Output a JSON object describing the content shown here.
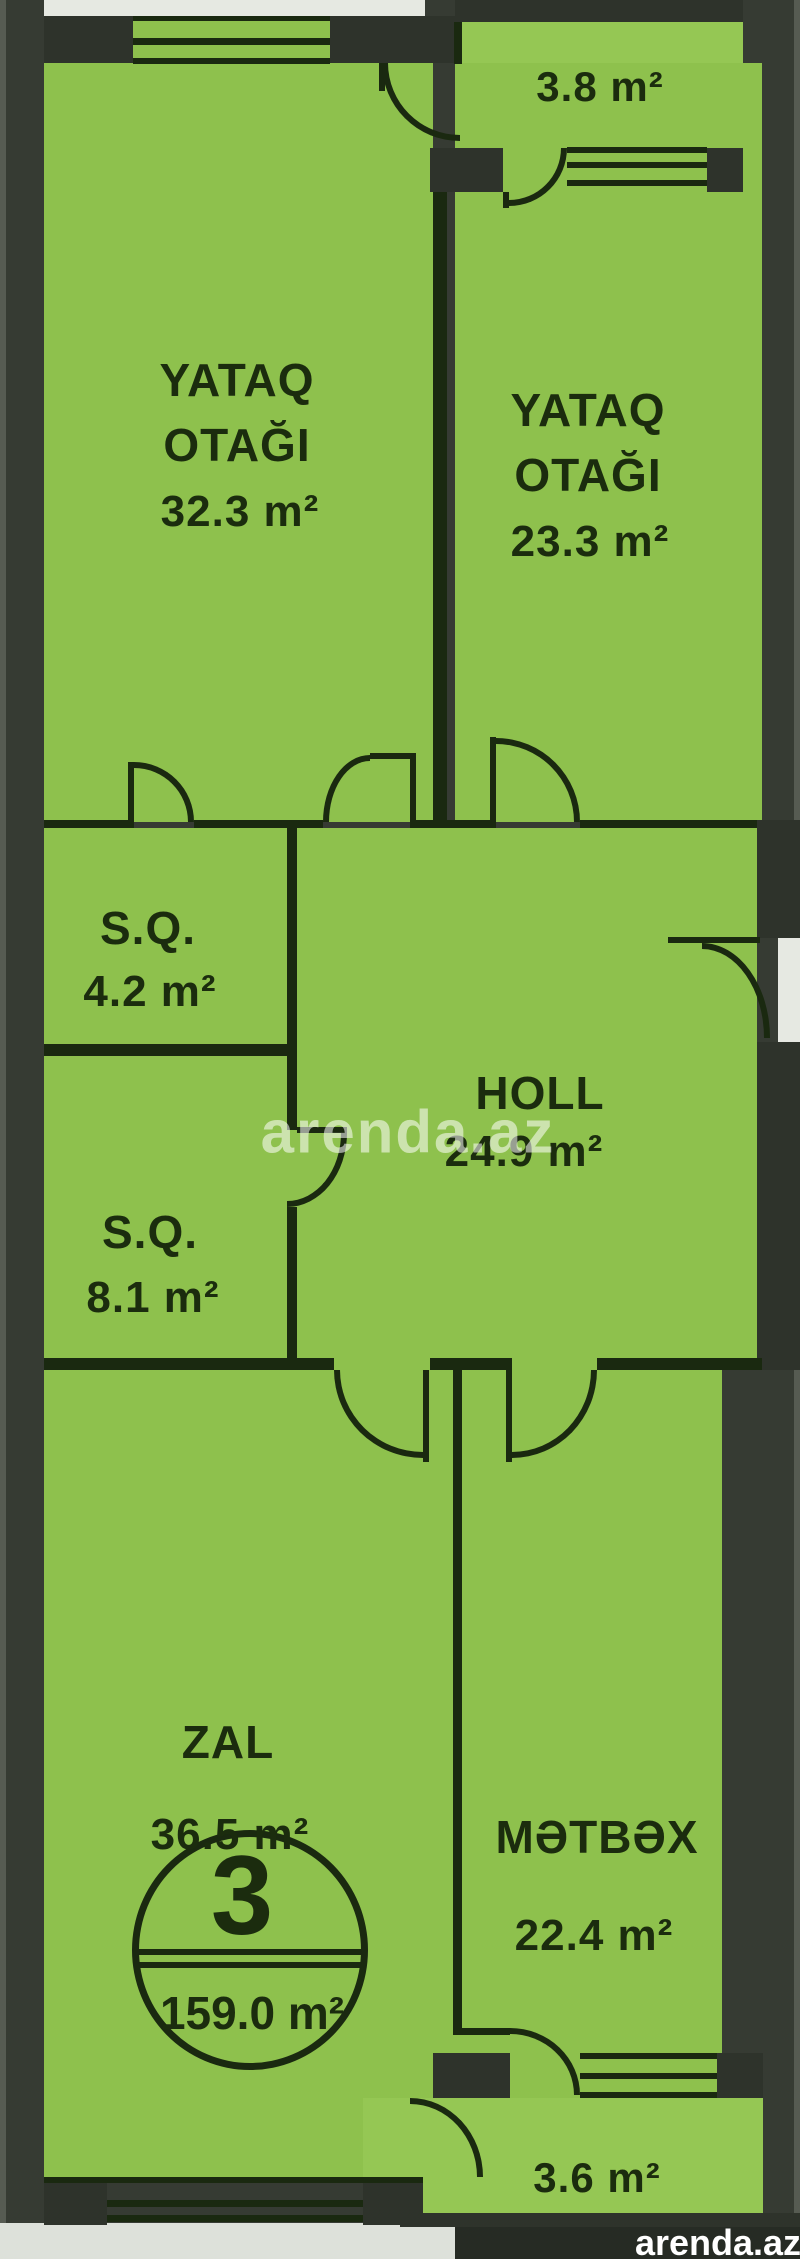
{
  "plan": {
    "type": "apartment-floor-plan",
    "language": "Azerbaijani",
    "colors": {
      "room_fill": "#8ec14d",
      "wall_dark": "#2e332b",
      "line_dark": "#1a2910",
      "outside_white": "#e6e9e2",
      "watermark_white": "#ffffff"
    },
    "rooms": [
      {
        "id": "balcony-top",
        "name": "",
        "area": "3.8 m²"
      },
      {
        "id": "bedroom-left",
        "name_line1": "YATAQ",
        "name_line2": "OTAĞI",
        "area": "32.3 m²"
      },
      {
        "id": "bedroom-right",
        "name_line1": "YATAQ",
        "name_line2": "OTAĞI",
        "area": "23.3 m²"
      },
      {
        "id": "sq-top",
        "name": "S.Q.",
        "area": "4.2 m²"
      },
      {
        "id": "holl",
        "name": "HOLL",
        "area": "24.9 m²"
      },
      {
        "id": "sq-bottom",
        "name": "S.Q.",
        "area": "8.1 m²"
      },
      {
        "id": "zal",
        "name": "ZAL",
        "area": "36.5 m²"
      },
      {
        "id": "metbex",
        "name": "MƏTBƏX",
        "area": "22.4 m²"
      },
      {
        "id": "balcony-bottom",
        "name": "",
        "area": "3.6 m²"
      }
    ],
    "unit_badge": {
      "number": "3",
      "total_area": "159.0 m²"
    },
    "watermarks": {
      "center": "arenda.az",
      "corner": "arenda.az"
    }
  }
}
